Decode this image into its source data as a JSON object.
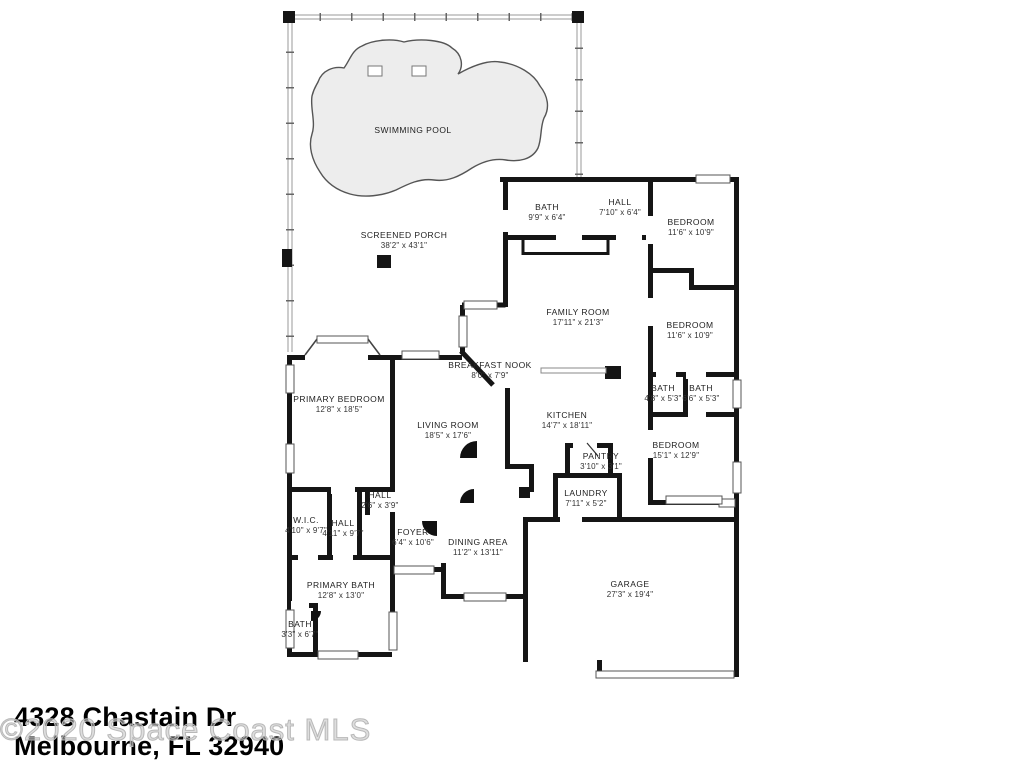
{
  "footer": {
    "address_line1": "4328 Chastain Dr",
    "address_line2": "Melbourne, FL 32940",
    "watermark": "©2020 Space Coast MLS"
  },
  "colors": {
    "wall": "#151515",
    "pool_fill": "#ededed",
    "pool_stroke": "#555555",
    "porch_screen": "#8a8a8a",
    "label_text": "#222222"
  },
  "rooms": [
    {
      "name": "SWIMMING POOL",
      "dims": ""
    },
    {
      "name": "SCREENED PORCH",
      "dims": "38'2\" x 43'1\""
    },
    {
      "name": "BATH",
      "dims": "9'9\" x 6'4\""
    },
    {
      "name": "HALL",
      "dims": "7'10\" x 6'4\""
    },
    {
      "name": "BEDROOM",
      "dims": "11'6\" x 10'9\""
    },
    {
      "name": "FAMILY ROOM",
      "dims": "17'11\" x 21'3\""
    },
    {
      "name": "BEDROOM",
      "dims": "11'6\" x 10'9\""
    },
    {
      "name": "BREAKFAST NOOK",
      "dims": "8'0\" x 7'9\""
    },
    {
      "name": "BATH",
      "dims": "4'8\" x 5'3\""
    },
    {
      "name": "BATH",
      "dims": "6'6\" x 5'3\""
    },
    {
      "name": "PRIMARY BEDROOM",
      "dims": "12'8\" x 18'5\""
    },
    {
      "name": "LIVING ROOM",
      "dims": "18'5\" x 17'6\""
    },
    {
      "name": "KITCHEN",
      "dims": "14'7\" x 18'11\""
    },
    {
      "name": "BEDROOM",
      "dims": "15'1\" x 12'9\""
    },
    {
      "name": "PANTRY",
      "dims": "3'10\" x 3'1\""
    },
    {
      "name": "LAUNDRY",
      "dims": "7'11\" x 5'2\""
    },
    {
      "name": "HALL",
      "dims": "2'6\" x 3'9\""
    },
    {
      "name": "W.I.C.",
      "dims": "4'10\" x 9'7\""
    },
    {
      "name": "HALL",
      "dims": "4'11\" x 9'7\""
    },
    {
      "name": "FOYER",
      "dims": "6'4\" x 10'6\""
    },
    {
      "name": "DINING AREA",
      "dims": "11'2\" x 13'11\""
    },
    {
      "name": "PRIMARY BATH",
      "dims": "12'8\" x 13'0\""
    },
    {
      "name": "BATH",
      "dims": "3'3\" x 6'7\""
    },
    {
      "name": "GARAGE",
      "dims": "27'3\" x 19'4\""
    }
  ]
}
